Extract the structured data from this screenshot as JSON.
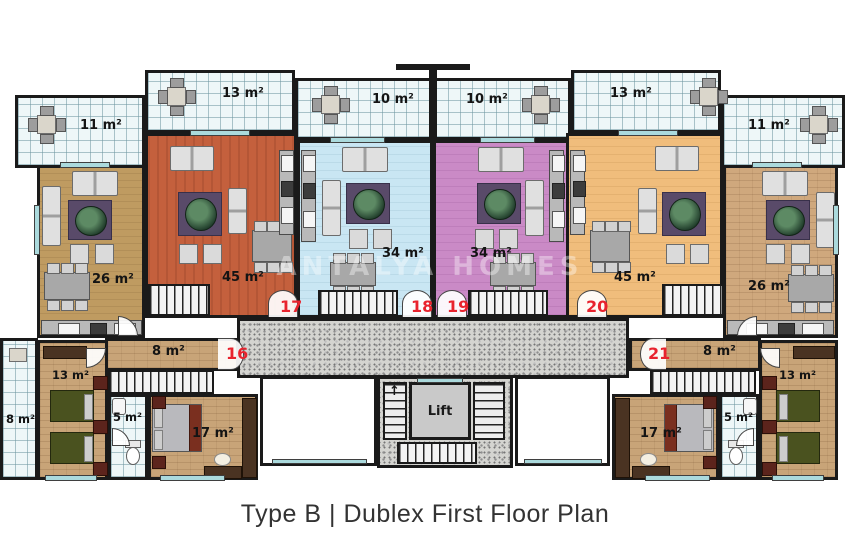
{
  "title": "Type B | Dublex First Floor Plan",
  "watermark": "ANTALYA HOMES",
  "lift_label": "Lift",
  "colors": {
    "living_tan": "#bf9b61",
    "living_terracotta": "#c4603d",
    "living_blue": "#c9e6f3",
    "living_pink": "#ca8ac6",
    "living_peach": "#f0bd7c",
    "living_brick": "#cfa87d",
    "bedroom_floor": "#c8a478",
    "balcony_tile": "#eef7f8",
    "corridor_granite": "#d4d4d0",
    "wall": "#1a1a1a",
    "unit_number_red": "#e8232e",
    "window_teal": "#abdadd"
  },
  "balconies": [
    {
      "id": "balcony-11-left",
      "area": "11 m²"
    },
    {
      "id": "balcony-13-left",
      "area": "13 m²"
    },
    {
      "id": "balcony-10-left",
      "area": "10 m²"
    },
    {
      "id": "balcony-10-right",
      "area": "10 m²"
    },
    {
      "id": "balcony-13-right",
      "area": "13 m²"
    },
    {
      "id": "balcony-11-right",
      "area": "11 m²"
    },
    {
      "id": "balcony-8-left",
      "area": "8 m²"
    }
  ],
  "rooms": {
    "living_26_left": "26 m²",
    "living_45_left": "45 m²",
    "living_34_left": "34 m²",
    "living_34_right": "34 m²",
    "living_45_right": "45 m²",
    "living_26_right": "26 m²",
    "hall_8_left": "8 m²",
    "bedroom_13_left": "13 m²",
    "bath_5_left": "5 m²",
    "bedroom_17_left": "17 m²",
    "hall_8_right": "8 m²",
    "bedroom_13_right": "13 m²",
    "bath_5_right": "5 m²",
    "bedroom_17_right": "17 m²"
  },
  "units": {
    "u16": "16",
    "u17": "17",
    "u18": "18",
    "u19": "19",
    "u20": "20",
    "u21": "21"
  }
}
